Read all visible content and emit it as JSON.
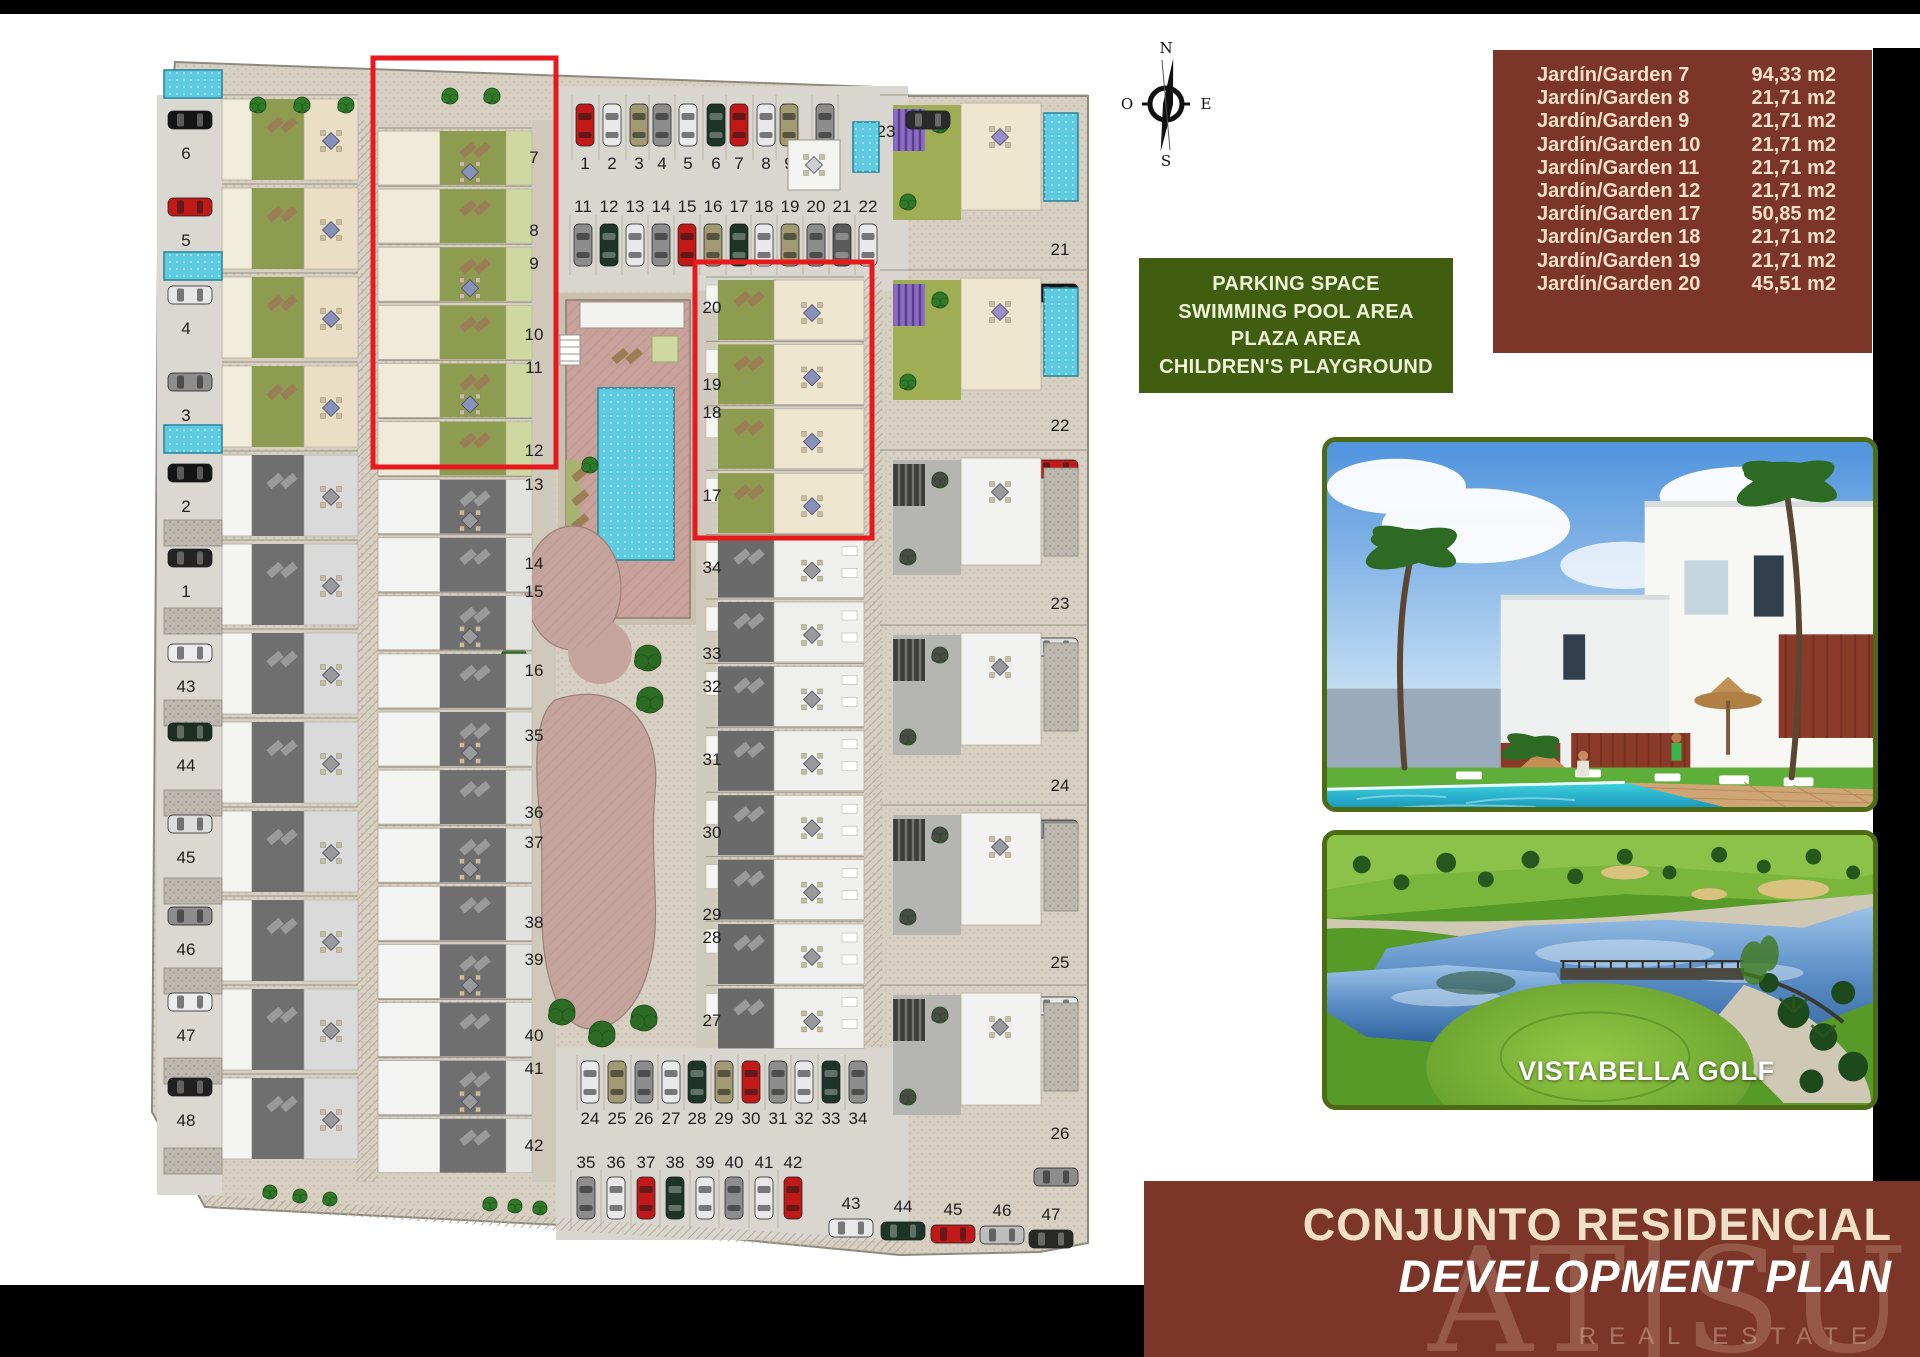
{
  "palette": {
    "maroon_box": "#7b3629",
    "legend_green": "#415e10",
    "photo_border_green": "#4d6b15",
    "red_highlight": "#e8191c",
    "pool_aqua": "#5ecbe0",
    "plan_beige": "#d7cfc1",
    "garden_olive": "#8e9c52"
  },
  "compass": {
    "north": "N",
    "south": "S",
    "east": "E",
    "west": "O"
  },
  "legend": {
    "lines": [
      "PARKING SPACE",
      "SWIMMING POOL AREA",
      "PLAZA AREA",
      "CHILDREN'S PLAYGROUND"
    ]
  },
  "garden_table": {
    "rows": [
      {
        "name": "Jardín/Garden 7",
        "area": "94,33 m2"
      },
      {
        "name": "Jardín/Garden 8",
        "area": "21,71 m2"
      },
      {
        "name": "Jardín/Garden 9",
        "area": "21,71 m2"
      },
      {
        "name": "Jardín/Garden 10",
        "area": "21,71 m2"
      },
      {
        "name": "Jardín/Garden 11",
        "area": "21,71 m2"
      },
      {
        "name": "Jardín/Garden 12",
        "area": "21,71 m2"
      },
      {
        "name": "Jardín/Garden 17",
        "area": "50,85 m2"
      },
      {
        "name": "Jardín/Garden 18",
        "area": "21,71 m2"
      },
      {
        "name": "Jardín/Garden 19",
        "area": "21,71 m2"
      },
      {
        "name": "Jardín/Garden 20",
        "area": "45,51 m2"
      }
    ]
  },
  "site_plan": {
    "labels": {
      "left_column": [
        "6",
        "5",
        "4",
        "3",
        "2",
        "1",
        "43",
        "44",
        "45",
        "46",
        "47",
        "48"
      ],
      "middle_column": [
        "7",
        "8",
        "9",
        "10",
        "11",
        "12",
        "13",
        "14",
        "15",
        "16",
        "35",
        "36",
        "37",
        "38",
        "39",
        "40",
        "41",
        "42"
      ],
      "inner_right_column": [
        "20",
        "19",
        "18",
        "17",
        "34",
        "33",
        "32",
        "31",
        "30",
        "29",
        "28",
        "27"
      ],
      "outer_right_column": [
        "21",
        "22",
        "23",
        "24",
        "25",
        "26"
      ],
      "top_parking_row_1": [
        "1",
        "2",
        "3",
        "4",
        "5",
        "6",
        "7",
        "8",
        "9",
        "10"
      ],
      "top_parking_row_2": [
        "11",
        "12",
        "13",
        "14",
        "15",
        "16",
        "17",
        "18",
        "19",
        "20",
        "21",
        "22"
      ],
      "top_right_space": "23",
      "bottom_parking_row_1": [
        "24",
        "25",
        "26",
        "27",
        "28",
        "29",
        "30",
        "31",
        "32",
        "33",
        "34"
      ],
      "bottom_parking_row_2": [
        "35",
        "36",
        "37",
        "38",
        "39",
        "40",
        "41",
        "42"
      ],
      "bottom_edge_spaces": [
        "43",
        "44",
        "45",
        "46",
        "47"
      ]
    }
  },
  "photos": {
    "golf_caption": "VISTABELLA GOLF"
  },
  "title_box": {
    "line1": "CONJUNTO RESIDENCIAL",
    "line2": "DEVELOPMENT PLAN",
    "watermark": "AT|SU",
    "watermark_sub": "REAL ESTATE"
  }
}
